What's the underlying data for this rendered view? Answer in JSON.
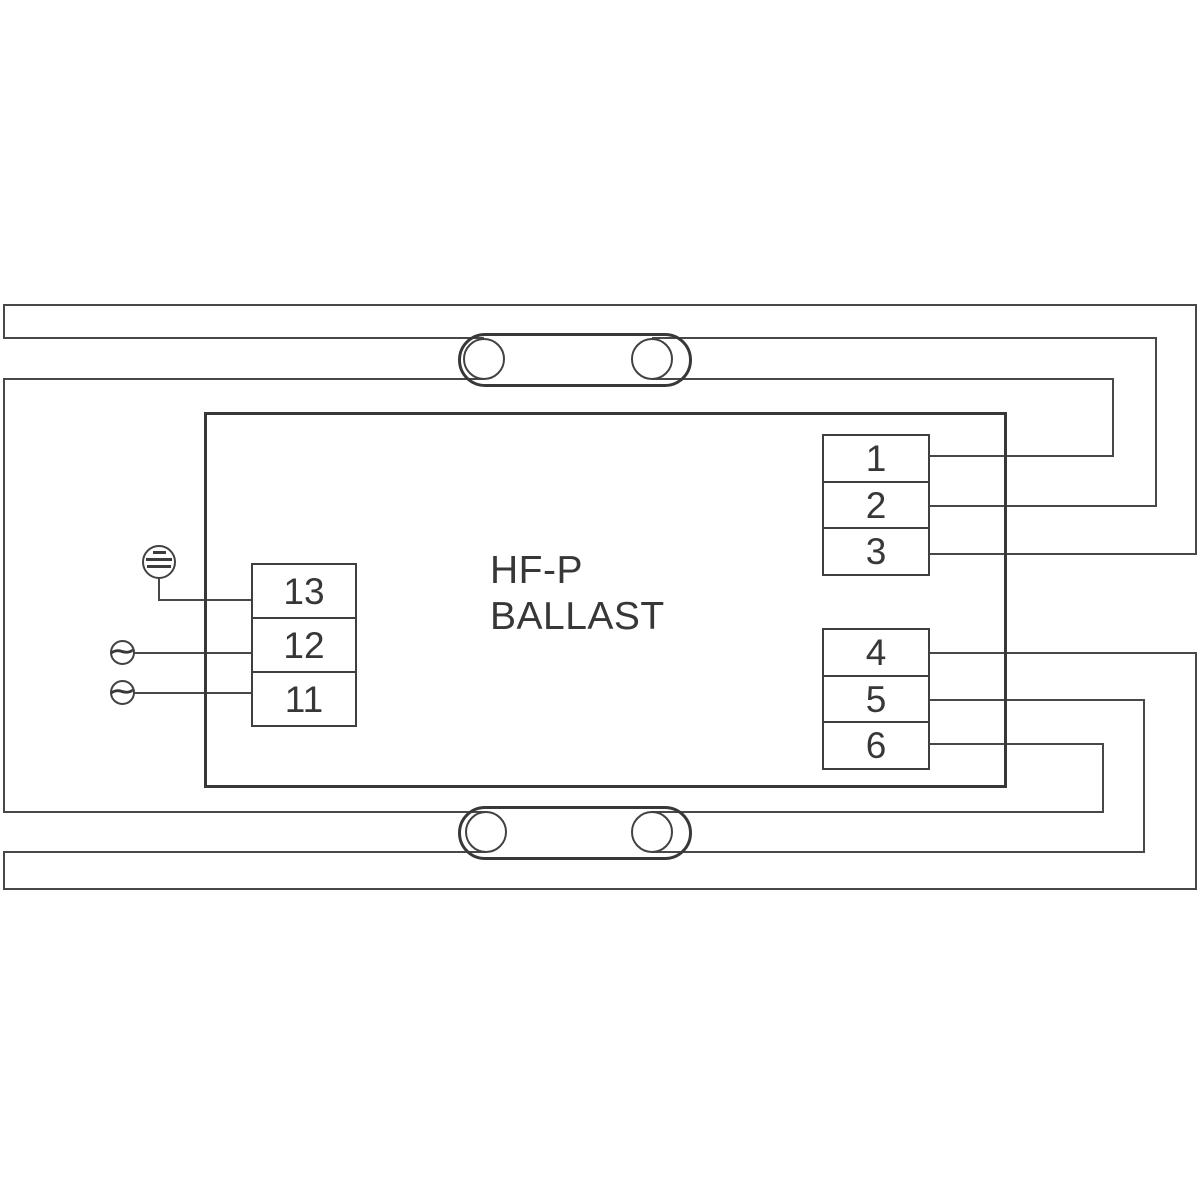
{
  "diagram": {
    "type": "ballast-wiring-diagram",
    "title_line1": "HF-P",
    "title_line2": "BALLAST",
    "mains_terminals": [
      "13",
      "12",
      "11"
    ],
    "lamp1_terminals": [
      "1",
      "2",
      "3"
    ],
    "lamp2_terminals": [
      "4",
      "5",
      "6"
    ],
    "ac_glyph": "∼",
    "icons": {
      "earth": "earth-ground-icon",
      "ac_source": "ac-source-icon",
      "lamp": "fluorescent-lamp-tube"
    },
    "colors": {
      "background": "#ffffff",
      "wire": "#484848",
      "outline": "#383838",
      "text": "#373737"
    }
  }
}
